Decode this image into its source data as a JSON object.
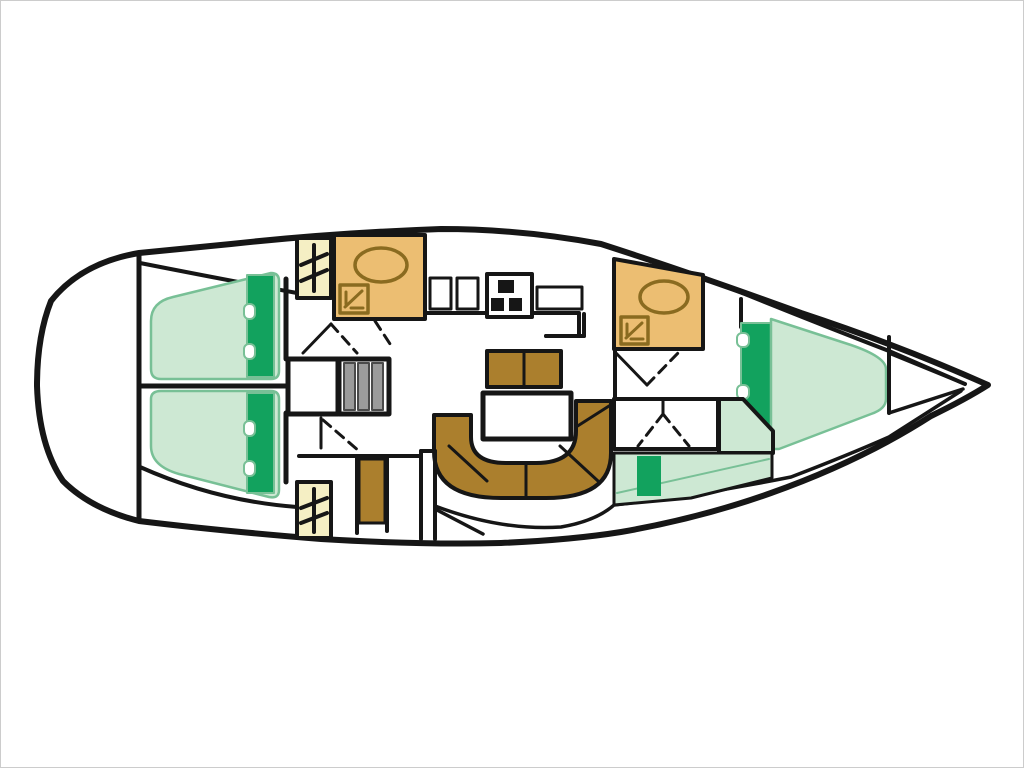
{
  "image": {
    "title": "Sailing yacht interior deck plan",
    "kind": "boat-floor-plan",
    "orientation": "bow-right-stern-left",
    "width_px": 1024,
    "height_px": 768
  },
  "palette": {
    "paper": "#ffffff",
    "frame": "#cccccc",
    "outline": "#161616",
    "berth": "#cde8d3",
    "berthStroke": "#78c096",
    "accent": "#12a25e",
    "wood": "#ab7f2d",
    "head": "#ecbe72",
    "headLine": "#8a6b20",
    "hatch": "#f5efc4",
    "steps": "#9b9b9b",
    "stepsLine": "#4a4a4a"
  },
  "components": [
    {
      "id": "hull-outline",
      "kind": "hull",
      "note": "pointed bow right, rounded stern left"
    },
    {
      "id": "stern-bulkhead",
      "kind": "wall"
    },
    {
      "id": "aft-double-berth-port",
      "kind": "berth",
      "color": "berth"
    },
    {
      "id": "aft-double-berth-starboard",
      "kind": "berth",
      "color": "berth"
    },
    {
      "id": "berth-headboard",
      "kind": "cushion-strip",
      "color": "accent"
    },
    {
      "id": "deck-hatch-port",
      "kind": "hatch-panel",
      "color": "hatch"
    },
    {
      "id": "deck-hatch-starboard",
      "kind": "hatch-panel",
      "color": "hatch"
    },
    {
      "id": "midship-head",
      "kind": "bathroom",
      "color": "head",
      "fixtures": [
        "washbasin-oval",
        "shower-tray"
      ]
    },
    {
      "id": "galley",
      "kind": "galley",
      "fixtures": [
        "twin-sinks",
        "stove-3-burner",
        "worktop"
      ]
    },
    {
      "id": "mast-compartment",
      "kind": "locker"
    },
    {
      "id": "companionway-steps",
      "kind": "stairs",
      "treads": 3,
      "color": "steps"
    },
    {
      "id": "saloon-bench",
      "kind": "seat",
      "color": "wood"
    },
    {
      "id": "saloon-table",
      "kind": "table"
    },
    {
      "id": "u-shaped-settee",
      "kind": "seat",
      "color": "wood"
    },
    {
      "id": "nav-seat",
      "kind": "seat",
      "color": "wood"
    },
    {
      "id": "forward-head",
      "kind": "bathroom",
      "color": "head",
      "fixtures": [
        "washbasin-oval",
        "shower-tray"
      ]
    },
    {
      "id": "corridor-locker",
      "kind": "locker"
    },
    {
      "id": "forward-v-berth",
      "kind": "berth",
      "color": "berth"
    },
    {
      "id": "side-settee",
      "kind": "seat",
      "color": "berth"
    },
    {
      "id": "settee-cushion",
      "kind": "cushion",
      "color": "accent"
    },
    {
      "id": "bow-locker-bulkhead",
      "kind": "wall"
    },
    {
      "id": "door-swings",
      "kind": "door-symbols",
      "style": "dashed"
    }
  ]
}
